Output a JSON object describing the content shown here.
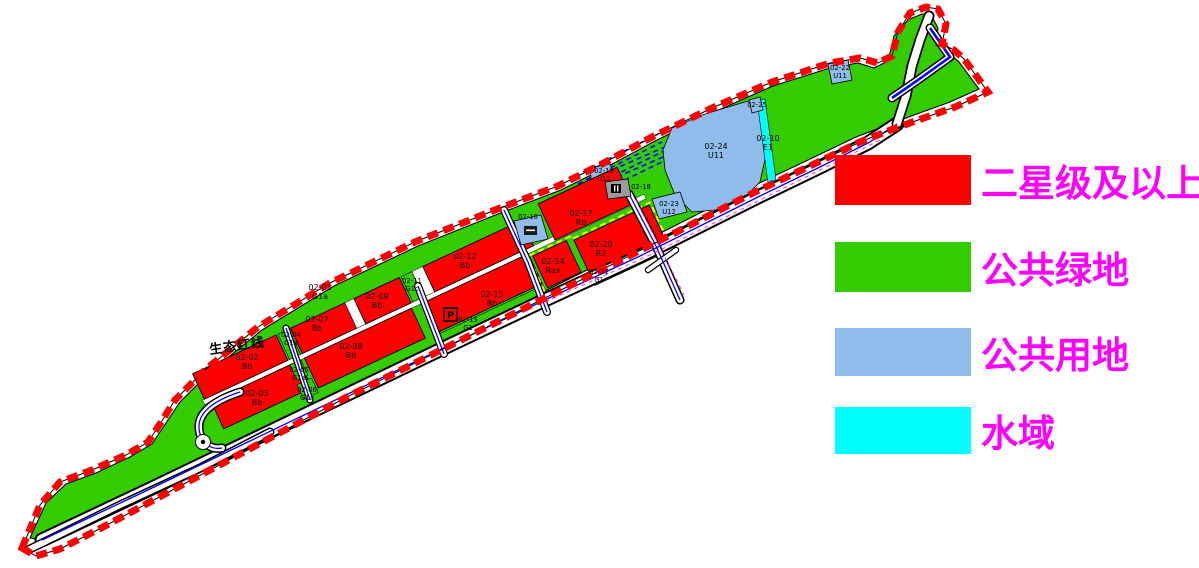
{
  "legend": {
    "text_color": "#FF00FF",
    "items": [
      {
        "label": "二星级及以上",
        "color": "#FF0000"
      },
      {
        "label": "公共绿地",
        "color": "#33CC00"
      },
      {
        "label": "公共用地",
        "color": "#8FBCEA"
      },
      {
        "label": "水域",
        "color": "#00FFFF"
      }
    ]
  },
  "map": {
    "boundary_label": "生态红线",
    "parking_label": "P",
    "colors": {
      "site_green": "#33CC00",
      "parcel_red": "#FF0000",
      "public_blue": "#8FBCEA",
      "water_cyan": "#00FFFF",
      "road_centerline_blue": "#0000FF",
      "boundary_dash_red": "#FF0000",
      "highlight_yellow": "#FFFF00",
      "facility_gray": "#9B9B9B",
      "legend_text_magenta": "#FF00FF"
    },
    "parcels": [
      {
        "code": "02-01",
        "use": "G1a"
      },
      {
        "code": "02-02",
        "use": "Bb"
      },
      {
        "code": "02-03",
        "use": "Bb"
      },
      {
        "code": "02-04",
        "use": "G1a"
      },
      {
        "code": "02-05",
        "use": "G1a"
      },
      {
        "code": "02-06",
        "use": "G1a"
      },
      {
        "code": "02-07",
        "use": "Bb"
      },
      {
        "code": "02-08",
        "use": "Bb"
      },
      {
        "code": "02-09",
        "use": "Bb"
      },
      {
        "code": "02-10",
        "use": "E1"
      },
      {
        "code": "02-11",
        "use": "G1c"
      },
      {
        "code": "02-12",
        "use": "Bb"
      },
      {
        "code": "02-13",
        "use": "Bb"
      },
      {
        "code": "02-14",
        "use": "Rax"
      },
      {
        "code": "02-15",
        "use": "G1"
      },
      {
        "code": "02-16",
        "use": ""
      },
      {
        "code": "02-17",
        "use": "Rb"
      },
      {
        "code": "02-18",
        "use": ""
      },
      {
        "code": "02-19",
        "use": "U11"
      },
      {
        "code": "02-20",
        "use": "R2"
      },
      {
        "code": "02-21",
        "use": "G1"
      },
      {
        "code": "02-22",
        "use": "U11"
      },
      {
        "code": "02-23",
        "use": "U12"
      },
      {
        "code": "02-24",
        "use": "U11"
      },
      {
        "code": "02-25",
        "use": ""
      }
    ]
  }
}
